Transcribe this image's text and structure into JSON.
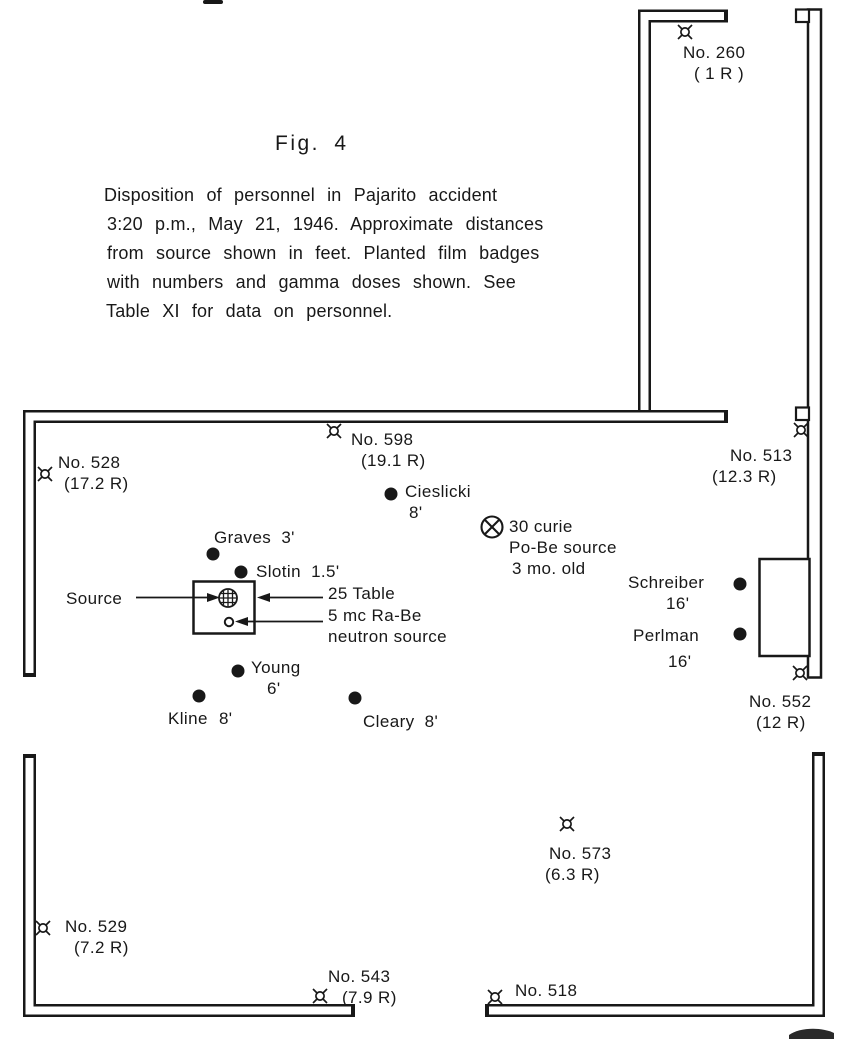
{
  "figure": {
    "title": "Fig. 4",
    "caption_lines": [
      "Disposition of personnel in Pajarito accident",
      "3:20 p.m., May 21, 1946. Approximate distances",
      "from source shown in feet. Planted film badges",
      "with numbers and gamma doses shown. See",
      "Table XI for data on personnel."
    ]
  },
  "badges": [
    {
      "id": "260",
      "label": "No. 260",
      "dose": "( 1 R )"
    },
    {
      "id": "528",
      "label": "No. 528",
      "dose": "(17.2 R)"
    },
    {
      "id": "598",
      "label": "No. 598",
      "dose": "(19.1 R)"
    },
    {
      "id": "513",
      "label": "No. 513",
      "dose": "(12.3 R)"
    },
    {
      "id": "552",
      "label": "No. 552",
      "dose": "(12 R)"
    },
    {
      "id": "573",
      "label": "No. 573",
      "dose": "(6.3 R)"
    },
    {
      "id": "529",
      "label": "No. 529",
      "dose": "(7.2 R)"
    },
    {
      "id": "543",
      "label": "No. 543",
      "dose": "(7.9 R)"
    },
    {
      "id": "518",
      "label": "No. 518",
      "dose": ""
    }
  ],
  "personnel": [
    {
      "name": "Cieslicki",
      "distance": "8'"
    },
    {
      "name": "Graves",
      "distance": "3'"
    },
    {
      "name": "Slotin",
      "distance": "1.5'"
    },
    {
      "name": "Young",
      "distance": "6'"
    },
    {
      "name": "Kline",
      "distance": "8'"
    },
    {
      "name": "Cleary",
      "distance": "8'"
    },
    {
      "name": "Schreiber",
      "distance": "16'"
    },
    {
      "name": "Perlman",
      "distance": "16'"
    }
  ],
  "annotations": {
    "source_label": "Source",
    "table_label": "25 Table",
    "neutron_source_line1": "5 mc Ra-Be",
    "neutron_source_line2": "neutron source",
    "pobe_line1": "30 curie",
    "pobe_line2": "Po-Be source",
    "pobe_line3": "3 mo. old"
  },
  "colors": {
    "ink": "#181818",
    "paper": "#ffffff"
  }
}
